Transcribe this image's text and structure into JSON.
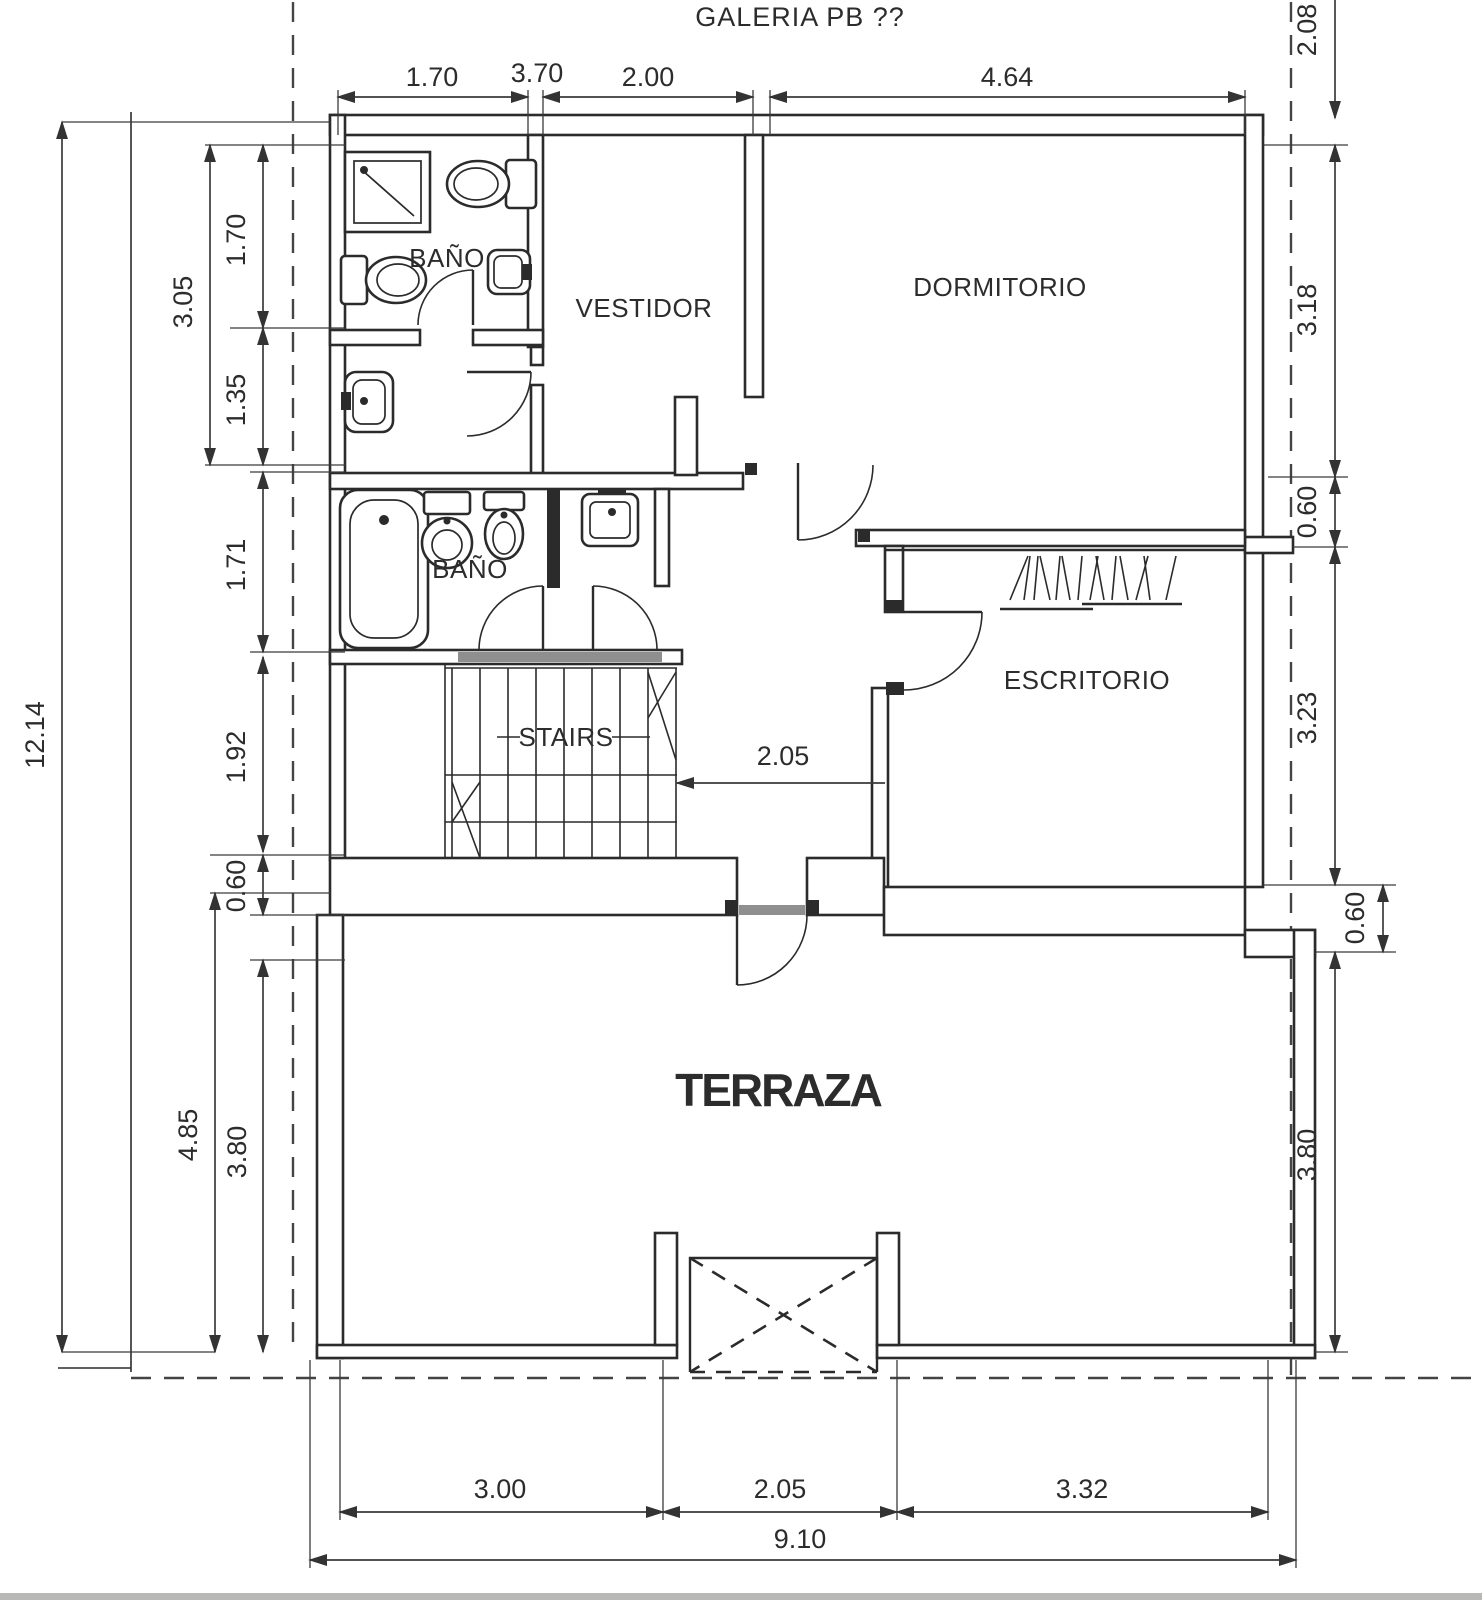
{
  "title": "GALERIA PB ??",
  "colors": {
    "line": "#2b2b2b",
    "dim": "#3a3a3a",
    "grey": "#8f8f8f",
    "paper": "#ffffff",
    "edge": "#b8b8b6"
  },
  "rooms": {
    "bano_top": "BAÑO",
    "vestidor": "VESTIDOR",
    "dormitorio": "DORMITORIO",
    "bano_main": "BAÑO",
    "stairs": "STAIRS",
    "escritorio": "ESCRITORIO",
    "terraza": "TERRAZA"
  },
  "dims": {
    "top": [
      "1.70",
      "3.70",
      "2.00",
      "4.64"
    ],
    "top_right": "2.08",
    "right": [
      "3.18",
      "0.60",
      "3.23",
      "0.60",
      "3.80"
    ],
    "left_outer": "12.14",
    "left": [
      "3.05",
      "1.70",
      "1.35",
      "1.71",
      "1.92",
      "0.60",
      "4.85",
      "3.80"
    ],
    "middle": "2.05",
    "bottom": [
      "3.00",
      "2.05",
      "3.32"
    ],
    "bottom_total": "9.10"
  }
}
